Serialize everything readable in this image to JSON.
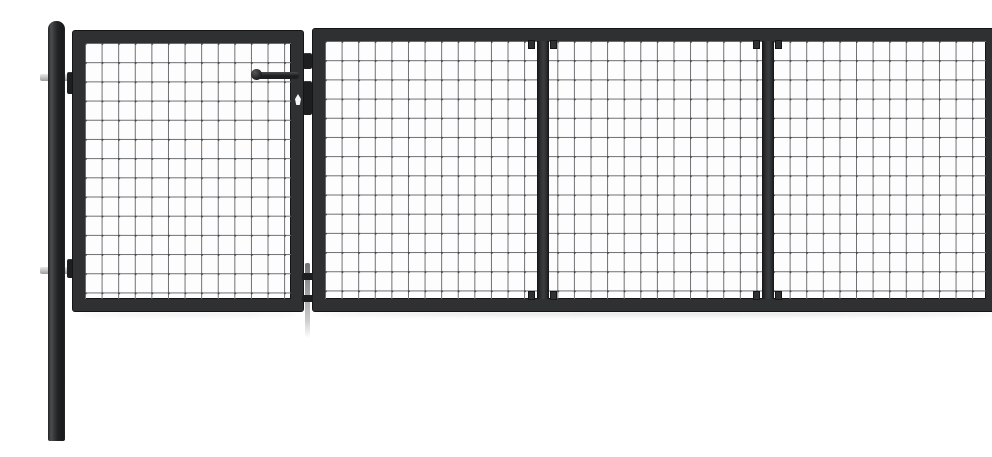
{
  "image": {
    "subject": "Anthracite grey steel mesh garden gate with two round-capped posts, a small pedestrian panel with handle and lock, and a wide three-section panel, on a white background"
  },
  "colors": {
    "canvas": "#ffffff",
    "frame_face": "#2e3032",
    "frame_edge": "#141516",
    "mesh_bg": "#fdfdfd",
    "mesh_wire": "#6b6e71",
    "mesh_wire_dark": "#3f4143",
    "post_light": "#4b4d4f",
    "post_dark": "#222426",
    "bracket_plate": "#c5c7c9",
    "hardware": "#1c1e20",
    "drop_rod": "#94979a",
    "drop_rod_light": "#c9cbcd",
    "keyhole": "#f4f5f5",
    "shadow": "#c7c9cb"
  },
  "mesh": {
    "cell_width_px": 16.6,
    "cell_height_px": 19.2
  },
  "parts": {
    "left_post": "round-capped fence post with two hinge bolts",
    "right_post": "round-capped fence post with two mounting brackets",
    "pedestrian_gate": "single mesh gate panel with lever handle, lock cylinder and latch",
    "main_gate": "wide mesh gate panel divided into 3 equal sections",
    "main_gate_sections": 3,
    "drop_rod": "ground drop bolt between the two panels",
    "handle": "lever handle on pedestrian gate",
    "keyhole": "cylinder keyhole below the handle"
  }
}
